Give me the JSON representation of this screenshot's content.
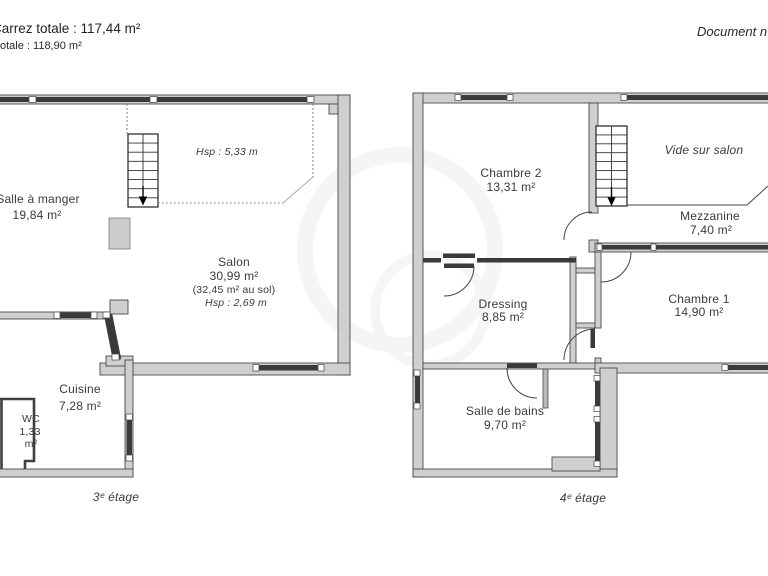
{
  "header": {
    "carrez_total": "Carrez totale : 117,44 m²",
    "surface_total": "otale : 118,90 m²",
    "document_note": "Document n"
  },
  "floor3": {
    "floor_label": "3ᵉ étage",
    "salle_a_manger": {
      "name": "Salle à manger",
      "area": "19,84 m²"
    },
    "hsp_mezzanine": "Hsp : 5,33 m",
    "salon": {
      "name": "Salon",
      "area": "30,99 m²",
      "floor_area": "(32,45 m² au sol)",
      "hsp": "Hsp : 2,69 m"
    },
    "cuisine": {
      "name": "Cuisine",
      "area": "7,28 m²"
    },
    "wc": {
      "name": "WC",
      "area_value": "1,33",
      "area_unit": "m²"
    }
  },
  "floor4": {
    "floor_label": "4ᵉ étage",
    "chambre2": {
      "name": "Chambre 2",
      "area": "13,31 m²"
    },
    "vide_sur_salon": "Vide sur salon",
    "mezzanine": {
      "name": "Mezzanine",
      "area": "7,40 m²"
    },
    "dressing": {
      "name": "Dressing",
      "area": "8,85 m²"
    },
    "chambre1": {
      "name": "Chambre 1",
      "area": "14,90 m²"
    },
    "salle_de_bains": {
      "name": "Salle de bains",
      "area": "9,70 m²"
    }
  },
  "colors": {
    "wall_fill": "#cfcfcf",
    "wall_outline": "#474747",
    "window_dark": "#3a3a3a",
    "text": "#3a3a3a"
  }
}
